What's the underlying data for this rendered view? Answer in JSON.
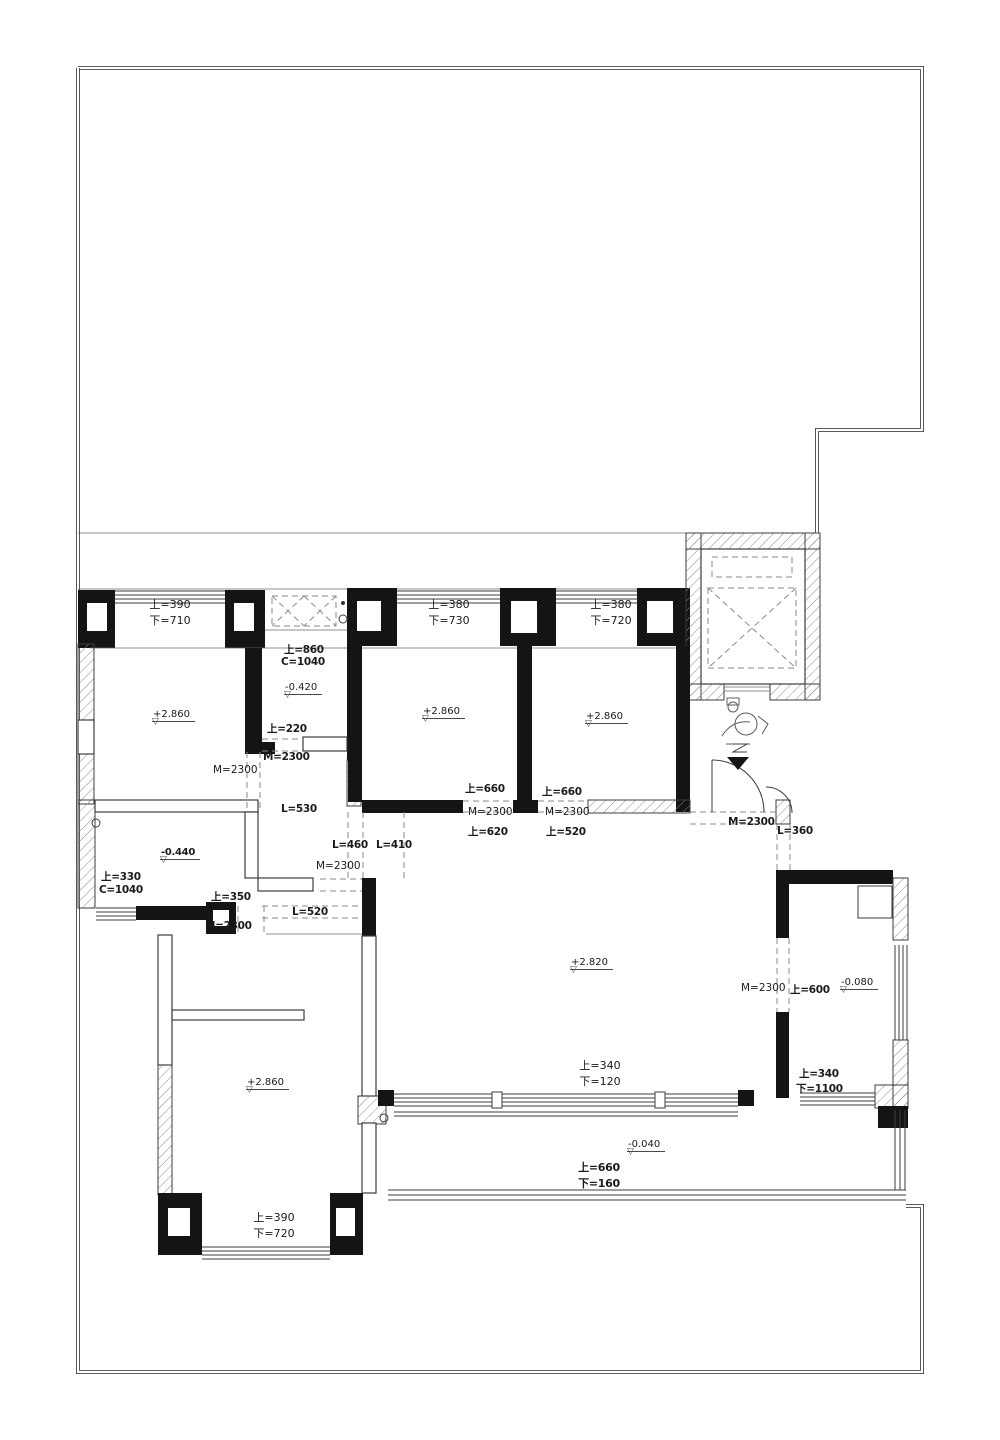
{
  "drawing_type": "residential-floor-plan",
  "colors": {
    "wall": "#141414",
    "line": "#3c3c3c",
    "dash": "#8a8a8a",
    "text": "#1b1b1b",
    "background": "#ffffff"
  },
  "windows": {
    "top_left": "上=390\n下=710",
    "top_mid": "上=380\n下=730",
    "top_right": "上=380\n下=720",
    "bottom_left": "上=390\n下=720",
    "living_south": "上=340\n下=120",
    "balcony_rail": "上=660\n下=160"
  },
  "levels": {
    "bed1": "+2.860",
    "bed2": "+2.860",
    "bed3": "+2.860",
    "bath1": "-0.420",
    "bath2": "-0.440",
    "living": "+2.820",
    "bed4": "+2.860",
    "kitchen": "-0.080",
    "balcony": "-0.040"
  },
  "dims": {
    "bath1_sill": "上=860",
    "bath1_win": "C=1040",
    "bath1_u220": "上=220",
    "bath1_door": "M=2300",
    "bed1_door": "M=2300",
    "hall_l530": "L=530",
    "bed2_u": "上=660",
    "bed2_door": "M=2300",
    "bed2_l": "上=620",
    "bed3_u": "上=660",
    "bed3_door": "M=2300",
    "bed3_l": "上=520",
    "hall_l460": "L=460",
    "hall_l410": "L=410",
    "hall_door": "M=2300",
    "hall_l520": "L=520",
    "bath2_sill": "上=330",
    "bath2_win": "C=1040",
    "bath2_u350": "上=350",
    "bath2_door": "M=2300",
    "entry_door": "M=2300",
    "entry_l360": "L=360",
    "kitchen_door": "M=2300",
    "kitchen_u600": "上=600",
    "kitchen_u340": "上=340",
    "kitchen_d1100": "下=1100"
  }
}
